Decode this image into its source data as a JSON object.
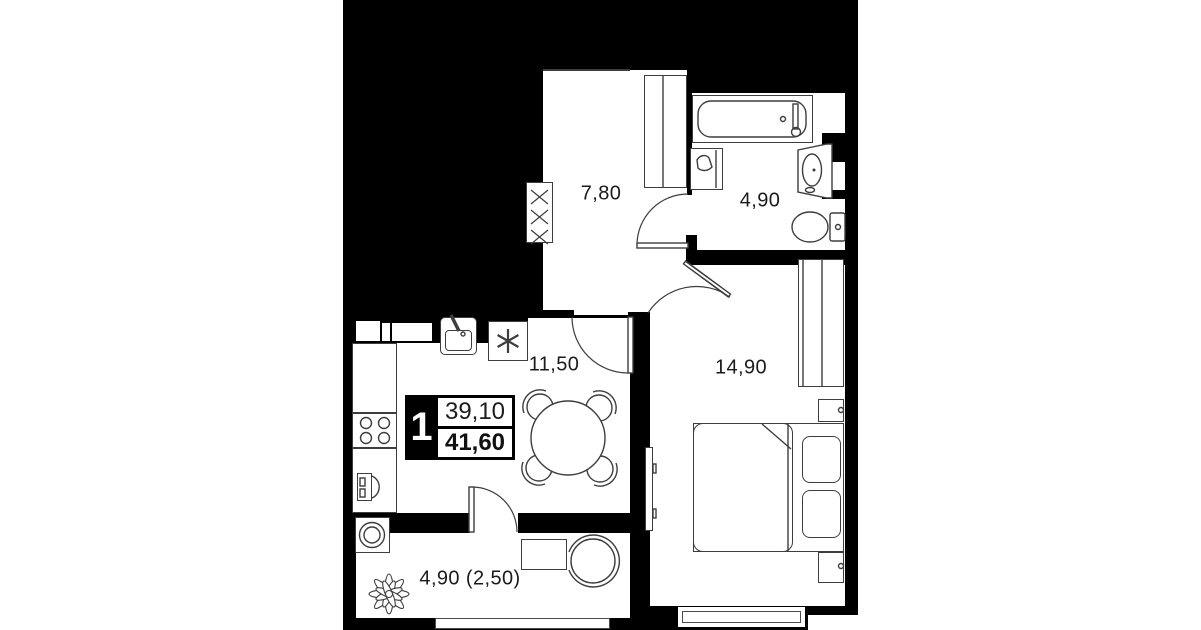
{
  "plan": {
    "badge": {
      "rooms_count": "1",
      "area_main": "39,10",
      "area_total": "41,60"
    },
    "rooms": {
      "hallway": {
        "area": "7,80"
      },
      "bathroom": {
        "area": "4,90"
      },
      "kitchen_living": {
        "area": "11,50"
      },
      "bedroom": {
        "area": "14,90"
      },
      "balcony": {
        "area": "4,90 (2,50)"
      }
    },
    "icons": {
      "fridge_snowflake": "✳",
      "wardrobe_cross": "✕"
    },
    "colors": {
      "canvas": "#ffffff",
      "card": "#000000",
      "room_fill": "#ffffff",
      "line": "#3d3d3d",
      "text": "#1b1b1b"
    }
  }
}
